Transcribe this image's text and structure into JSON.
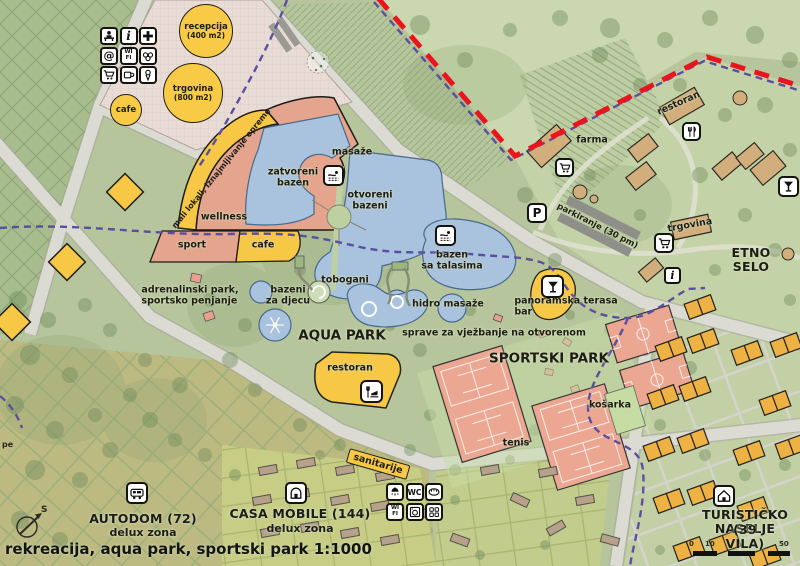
{
  "legend": {
    "title": "rekreacija, aqua park, sportski park 1:1000"
  },
  "compass": {
    "north": "S"
  },
  "scalebar": {
    "t0": "0",
    "t10": "10",
    "t50": "50"
  },
  "plaza": {
    "recepcija": "recepcija",
    "recepcija_sub": "(400 m2)",
    "trgovina": "trgovina",
    "trgovina_sub": "(800 m2)",
    "cafe": "cafe"
  },
  "icons": {
    "info": "i",
    "at": "@",
    "wifi": "WI\nFI",
    "wc": "WC",
    "parking": "P"
  },
  "zones": {
    "aqua": "AQUA PARK",
    "sport": "SPORTSKI PARK",
    "etno": "ETNO SELO",
    "autodom": "AUTODOM (72)",
    "autodom_sub": "delux zona",
    "casa": "CASA MOBILE (144)",
    "casa_sub": "delux zona",
    "turisticko": "TURISTIČKO NASELJE",
    "turisticko_sub": "(39 VILA)"
  },
  "labels": {
    "mali_lokali": "mali lokali, iznajmljivanje opreme",
    "zatvoreni": "zatvoreni\nbazen",
    "masaze": "masaže",
    "otvoreni": "otvoreni\nbazeni",
    "wellness": "wellness",
    "sport": "sport",
    "cafe": "cafe",
    "tobogani": "tobogani",
    "bazeni_djecu": "bazeni\nza djecu",
    "restoran_aqua": "restoran",
    "hidro": "hidro masaže",
    "talasima": "bazen\nsa talasima",
    "panoramska": "panoramska terasa\nbar",
    "sprave": "sprave za vježbanje na otvorenom",
    "kosarka": "košarka",
    "tenis": "tenis",
    "adrenalinski": "adrenalinski park,\nsportsko penjanje",
    "restoran_etno": "restoran",
    "farma": "farma",
    "parkiranje": "parkiranje (30 pm)",
    "trgovina_etno": "trgovina",
    "sanitarije": "sanitarije",
    "edge_partial": "pe"
  },
  "colors": {
    "accent_yellow": "#f7c846",
    "salmon": "#e5a48d",
    "pool_blue": "#a9c2de",
    "boundary_red": "#e8141e",
    "path_purple": "#5a4fa0"
  }
}
